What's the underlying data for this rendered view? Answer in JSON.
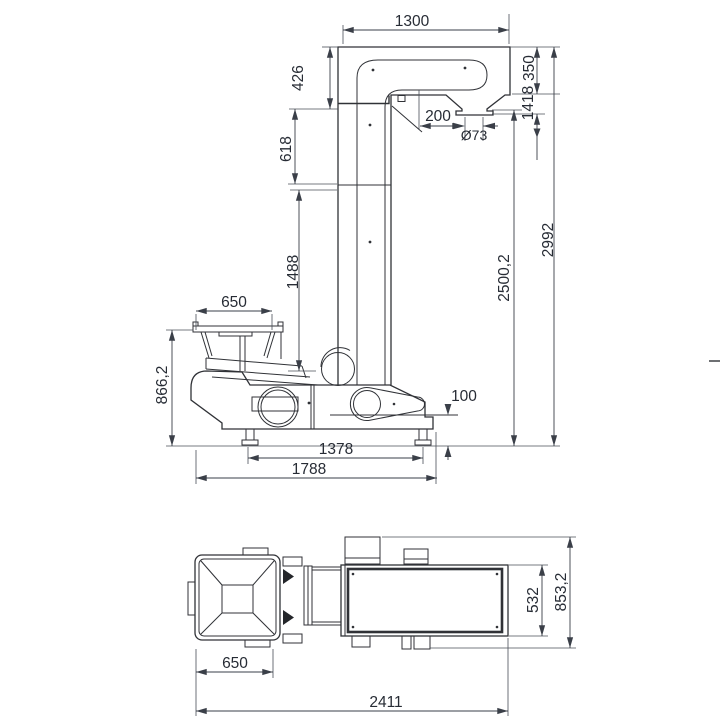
{
  "side_view": {
    "dims": {
      "arm_width": "1300",
      "arm_front_height": "426",
      "column_upper_height": "618",
      "column_lower_height": "1488",
      "arm_depth": "350",
      "outlet_drop": "1418",
      "outlet_offset": "200",
      "outlet_diameter": "Ø73",
      "discharge_height": "2500,2",
      "total_height": "2992",
      "hopper_width": "650",
      "hopper_height": "866,2",
      "base_clearance": "100",
      "feet_span": "1378",
      "base_length": "1788"
    }
  },
  "top_view": {
    "dims": {
      "body_width": "532",
      "overall_width": "853,2",
      "hopper_width": "650",
      "overall_length": "2411"
    }
  }
}
